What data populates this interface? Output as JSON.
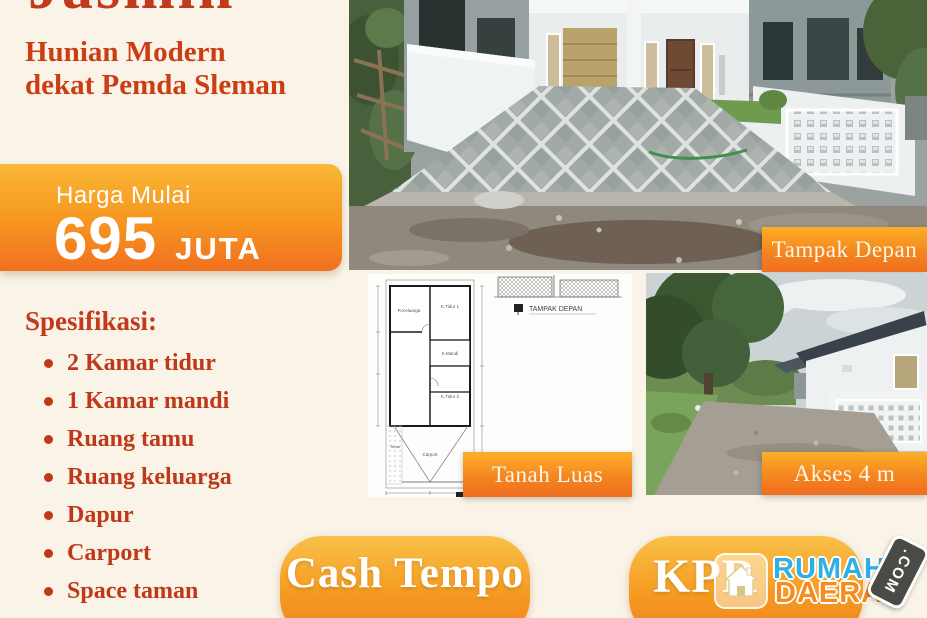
{
  "title": "Jasmin",
  "subtitle": {
    "line1": "Hunian Modern",
    "line2": "dekat Pemda Sleman"
  },
  "price": {
    "label": "Harga Mulai",
    "amount": "695",
    "unit": "JUTA"
  },
  "specs": {
    "heading": "Spesifikasi:",
    "items": [
      "2 Kamar tidur",
      "1 Kamar mandi",
      "Ruang tamu",
      "Ruang keluarga",
      "Dapur",
      "Carport",
      "Space taman"
    ]
  },
  "photo_labels": {
    "front": "Tampak Depan",
    "plan": "Tanah Luas",
    "access": "Akses 4 m"
  },
  "floor_plan": {
    "elevation_title": "TAMPAK DEPAN",
    "plan_title": "DENAH",
    "rooms": [
      "R.Keluarga",
      "K.Tidur 1",
      "K.Mandi",
      "K.Tidur 2",
      "Carport",
      "Teras"
    ]
  },
  "buttons": {
    "cash_tempo": "Cash Tempo",
    "kpr": "KPR"
  },
  "logo": {
    "word1": "RUMAH",
    "word2": "DAERAH",
    "tld": ".COM"
  },
  "colors": {
    "background": "#faf3e7",
    "accent_red": "#c2391b",
    "orange_top": "#f9b735",
    "orange_bottom": "#f1701f",
    "logo_blue": "#2fb0e5",
    "logo_orange": "#f68b1f",
    "badge_dark": "#4a4a47"
  }
}
